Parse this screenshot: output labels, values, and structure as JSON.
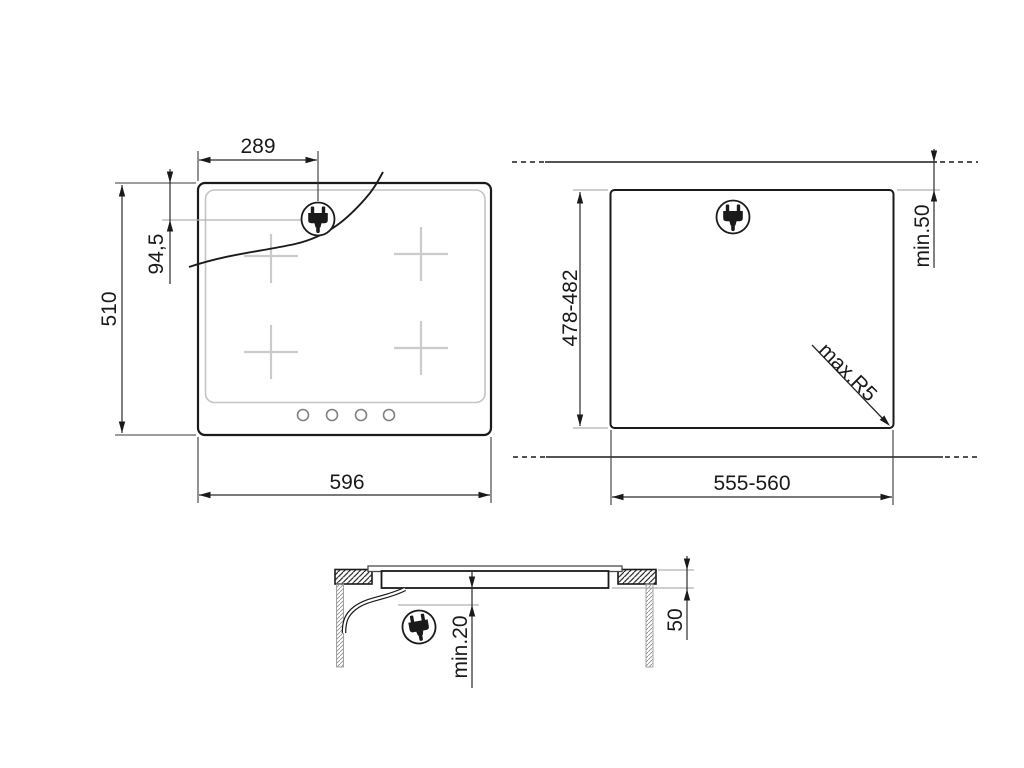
{
  "figure": {
    "type": "appliance-installation-drawing",
    "colors": {
      "ink": "#1a1a1a",
      "dim_line": "#2a2a2a",
      "light_gray": "#b0b0b0",
      "zone_gray": "#c9c9c9",
      "knob_gray": "#808080"
    },
    "hob_top_view": {
      "dims": {
        "plug_offset_x": "289",
        "plug_offset_y": "94,5",
        "height": "510",
        "width": "596"
      },
      "icons": {
        "plug": "power-plug-icon"
      }
    },
    "cutout_view": {
      "dims": {
        "depth": "478-482",
        "rear_clearance": "min.50",
        "corner_radius": "max.R5",
        "width": "555-560"
      },
      "icons": {
        "plug": "power-plug-icon"
      }
    },
    "section_view": {
      "dims": {
        "clearance_below": "min.20",
        "recess_depth": "50"
      },
      "icons": {
        "plug": "power-plug-icon"
      }
    }
  }
}
